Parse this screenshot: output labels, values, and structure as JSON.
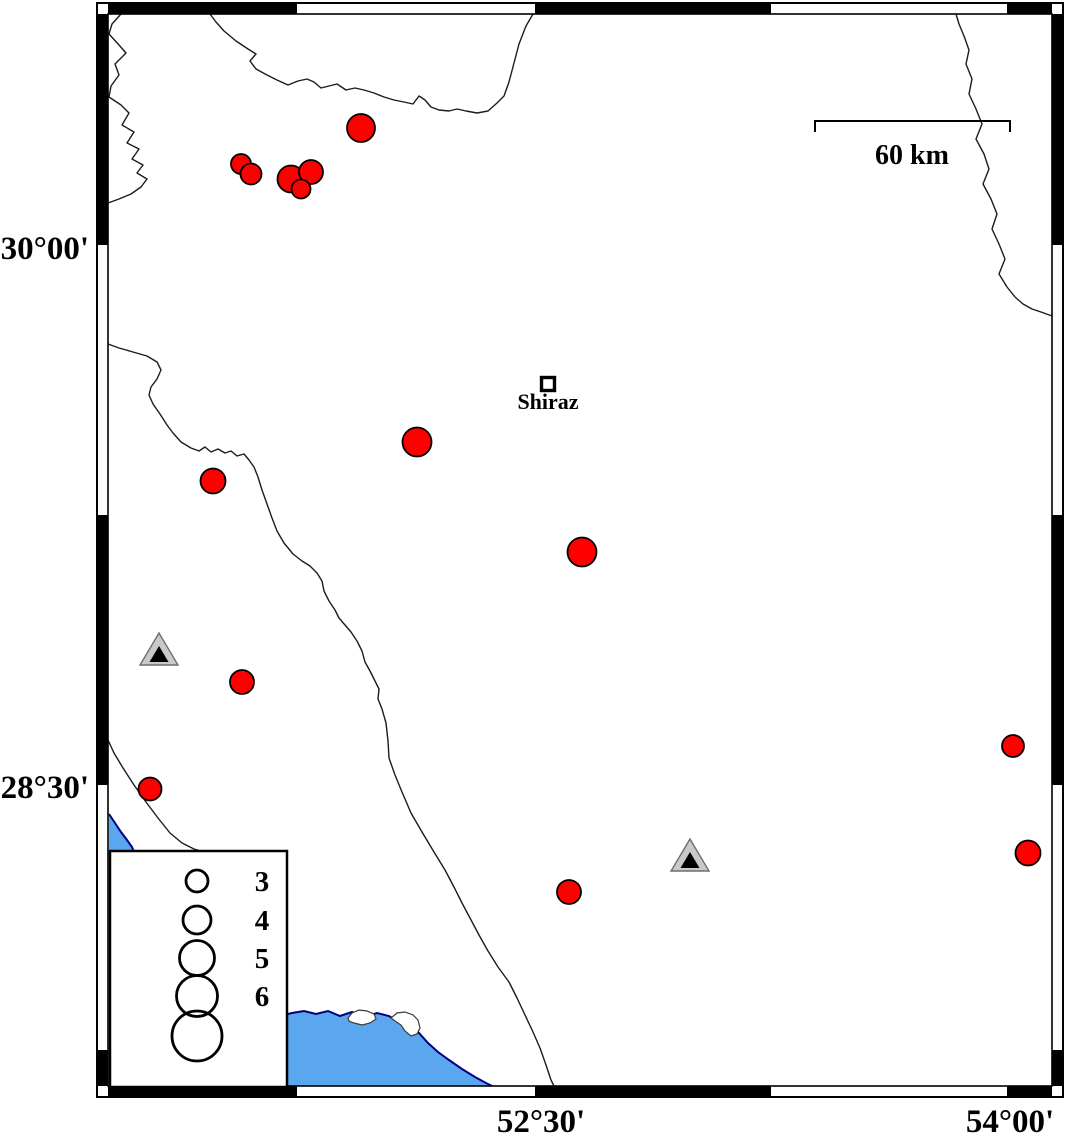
{
  "map": {
    "width": 1066,
    "height": 1136,
    "colors": {
      "background": "#ffffff",
      "frame": "#000000",
      "quake_fill": "#ff0000",
      "quake_stroke": "#000000",
      "station_fill": "#c9c9c9",
      "station_stroke": "#6e6e6e",
      "station_inner": "#000000",
      "water_fill": "#5aa7f0",
      "coast_stroke": "#000080",
      "river_stroke": "#1c1c1c",
      "island_fill": "#ffffff",
      "island_stroke": "#3a3a3a"
    },
    "frame": {
      "outer": {
        "x": 97,
        "y": 3,
        "w": 966,
        "h": 1094
      },
      "inner": {
        "x": 108,
        "y": 14,
        "w": 944,
        "h": 1072
      },
      "h_black_segments": [
        [
          108,
          297
        ],
        [
          535,
          771
        ],
        [
          1007,
          1052
        ]
      ],
      "v_black_segments": [
        [
          14,
          245
        ],
        [
          515,
          785
        ],
        [
          1050,
          1086
        ]
      ]
    },
    "axis_labels": {
      "left": [
        {
          "text": "30°00'",
          "y": 259
        },
        {
          "text": "28°30'",
          "y": 798
        }
      ],
      "bottom": [
        {
          "text": "52°30'",
          "x": 541
        },
        {
          "text": "54°00'",
          "x": 1010
        }
      ]
    },
    "scale_bar": {
      "x1": 815,
      "x2": 1010,
      "y": 121,
      "tick_drop": 11,
      "label": "60 km"
    },
    "city": {
      "name": "Shiraz",
      "x": 548,
      "y": 384,
      "marker_size": 13
    },
    "earthquakes": [
      {
        "x": 361,
        "y": 128,
        "r": 14
      },
      {
        "x": 241,
        "y": 164,
        "r": 10
      },
      {
        "x": 251,
        "y": 174,
        "r": 10.5
      },
      {
        "x": 291,
        "y": 179,
        "r": 13.5
      },
      {
        "x": 311,
        "y": 172,
        "r": 12
      },
      {
        "x": 301,
        "y": 189,
        "r": 9.5
      },
      {
        "x": 417,
        "y": 442,
        "r": 14.5
      },
      {
        "x": 213,
        "y": 481,
        "r": 12.5
      },
      {
        "x": 582,
        "y": 552,
        "r": 14.5
      },
      {
        "x": 242,
        "y": 682,
        "r": 12
      },
      {
        "x": 150,
        "y": 789,
        "r": 11.5
      },
      {
        "x": 569,
        "y": 892,
        "r": 12
      },
      {
        "x": 1013,
        "y": 746,
        "r": 11
      },
      {
        "x": 1028,
        "y": 853,
        "r": 12.5
      }
    ],
    "stations": [
      {
        "x": 159,
        "y": 649
      },
      {
        "x": 690,
        "y": 855
      }
    ],
    "station_shape": {
      "half_w": 19,
      "half_h": 16,
      "inner_half_w": 9.5,
      "inner_apex_dy": 13,
      "inner_base_dy": 13
    },
    "legend": {
      "box": {
        "x": 110,
        "y": 851,
        "w": 177,
        "h": 236
      },
      "circle_cx": 197,
      "label_x": 262,
      "entries": [
        {
          "label": "3",
          "cy": 881,
          "r": 11
        },
        {
          "label": "4",
          "cy": 920,
          "r": 14
        },
        {
          "label": "5",
          "cy": 958,
          "r": 17.5
        },
        {
          "label": "6",
          "cy": 996,
          "r": 20.5
        },
        {
          "label": "",
          "cy": 1036,
          "r": 25
        }
      ]
    },
    "rivers": [
      {
        "name": "northwest-border",
        "points": [
          [
            121,
            14
          ],
          [
            112,
            24
          ],
          [
            109,
            34
          ],
          [
            119,
            45
          ],
          [
            126,
            53
          ],
          [
            115,
            64
          ],
          [
            119,
            75
          ],
          [
            111,
            86
          ],
          [
            109,
            97
          ],
          [
            121,
            105
          ],
          [
            129,
            113
          ],
          [
            122,
            125
          ],
          [
            134,
            132
          ],
          [
            127,
            143
          ],
          [
            139,
            149
          ],
          [
            132,
            159
          ],
          [
            143,
            165
          ],
          [
            137,
            173
          ],
          [
            147,
            179
          ],
          [
            141,
            187
          ],
          [
            131,
            194
          ],
          [
            119,
            199
          ],
          [
            108,
            203
          ]
        ]
      },
      {
        "name": "west-diagonal-border",
        "points": [
          [
            108,
            344
          ],
          [
            119,
            348
          ],
          [
            133,
            352
          ],
          [
            147,
            356
          ],
          [
            157,
            362
          ],
          [
            161,
            370
          ],
          [
            157,
            379
          ],
          [
            151,
            387
          ],
          [
            149,
            395
          ],
          [
            153,
            404
          ],
          [
            160,
            414
          ],
          [
            167,
            425
          ],
          [
            173,
            433
          ],
          [
            181,
            442
          ],
          [
            191,
            448
          ],
          [
            199,
            451
          ],
          [
            205,
            447
          ],
          [
            211,
            452
          ],
          [
            218,
            449
          ],
          [
            225,
            453
          ],
          [
            231,
            451
          ],
          [
            237,
            456
          ],
          [
            244,
            454
          ],
          [
            249,
            460
          ],
          [
            254,
            467
          ],
          [
            258,
            477
          ],
          [
            262,
            490
          ],
          [
            267,
            504
          ],
          [
            272,
            518
          ],
          [
            277,
            531
          ],
          [
            284,
            543
          ],
          [
            293,
            554
          ],
          [
            302,
            561
          ],
          [
            310,
            566
          ],
          [
            317,
            573
          ],
          [
            322,
            581
          ],
          [
            324,
            591
          ],
          [
            329,
            601
          ],
          [
            335,
            610
          ],
          [
            339,
            618
          ],
          [
            345,
            625
          ],
          [
            351,
            632
          ],
          [
            357,
            641
          ],
          [
            362,
            651
          ],
          [
            365,
            662
          ],
          [
            370,
            671
          ],
          [
            374,
            679
          ],
          [
            379,
            689
          ],
          [
            378,
            699
          ],
          [
            382,
            709
          ],
          [
            386,
            723
          ],
          [
            388,
            741
          ],
          [
            389,
            758
          ],
          [
            395,
            775
          ],
          [
            402,
            792
          ],
          [
            411,
            813
          ],
          [
            422,
            832
          ],
          [
            434,
            852
          ],
          [
            445,
            870
          ],
          [
            454,
            887
          ],
          [
            462,
            903
          ],
          [
            470,
            918
          ],
          [
            479,
            935
          ],
          [
            488,
            951
          ],
          [
            498,
            967
          ],
          [
            509,
            982
          ],
          [
            517,
            998
          ],
          [
            525,
            1015
          ],
          [
            533,
            1032
          ],
          [
            540,
            1048
          ],
          [
            546,
            1065
          ],
          [
            551,
            1080
          ],
          [
            554,
            1086
          ]
        ]
      },
      {
        "name": "north-valley-border",
        "points": [
          [
            210,
            14
          ],
          [
            216,
            22
          ],
          [
            224,
            31
          ],
          [
            236,
            41
          ],
          [
            248,
            49
          ],
          [
            256,
            54
          ],
          [
            250,
            61
          ],
          [
            256,
            69
          ],
          [
            267,
            75
          ],
          [
            277,
            80
          ],
          [
            288,
            85
          ],
          [
            298,
            81
          ],
          [
            307,
            79
          ],
          [
            314,
            82
          ],
          [
            321,
            88
          ],
          [
            329,
            86
          ],
          [
            337,
            84
          ],
          [
            346,
            90
          ],
          [
            355,
            88
          ],
          [
            364,
            90
          ],
          [
            374,
            93
          ],
          [
            384,
            97
          ],
          [
            394,
            100
          ],
          [
            404,
            102
          ],
          [
            413,
            104
          ],
          [
            419,
            96
          ],
          [
            425,
            100
          ],
          [
            431,
            107
          ],
          [
            439,
            110
          ],
          [
            449,
            111
          ],
          [
            457,
            109
          ],
          [
            466,
            111
          ],
          [
            477,
            113
          ],
          [
            488,
            111
          ],
          [
            497,
            103
          ],
          [
            504,
            96
          ],
          [
            509,
            82
          ],
          [
            514,
            63
          ],
          [
            519,
            44
          ],
          [
            526,
            26
          ],
          [
            533,
            14
          ]
        ]
      },
      {
        "name": "east-river",
        "points": [
          [
            956,
            14
          ],
          [
            959,
            24
          ],
          [
            964,
            36
          ],
          [
            969,
            50
          ],
          [
            966,
            64
          ],
          [
            972,
            79
          ],
          [
            969,
            94
          ],
          [
            976,
            109
          ],
          [
            982,
            124
          ],
          [
            976,
            139
          ],
          [
            984,
            154
          ],
          [
            989,
            169
          ],
          [
            983,
            184
          ],
          [
            991,
            199
          ],
          [
            997,
            214
          ],
          [
            992,
            229
          ],
          [
            999,
            244
          ],
          [
            1005,
            259
          ],
          [
            999,
            274
          ],
          [
            1007,
            287
          ],
          [
            1015,
            297
          ],
          [
            1023,
            304
          ],
          [
            1032,
            309
          ],
          [
            1041,
            312
          ],
          [
            1052,
            316
          ]
        ]
      },
      {
        "name": "southwest-line",
        "points": [
          [
            108,
            740
          ],
          [
            114,
            753
          ],
          [
            123,
            768
          ],
          [
            134,
            785
          ],
          [
            146,
            802
          ],
          [
            158,
            818
          ],
          [
            170,
            833
          ],
          [
            182,
            843
          ],
          [
            194,
            849
          ],
          [
            208,
            853
          ]
        ]
      }
    ],
    "water_bodies": [
      {
        "name": "gulf",
        "points": [
          [
            280,
            1016
          ],
          [
            292,
            1013
          ],
          [
            304,
            1011
          ],
          [
            316,
            1014
          ],
          [
            328,
            1011
          ],
          [
            340,
            1016
          ],
          [
            352,
            1012
          ],
          [
            364,
            1017
          ],
          [
            377,
            1013
          ],
          [
            389,
            1016
          ],
          [
            397,
            1021
          ],
          [
            405,
            1018
          ],
          [
            412,
            1026
          ],
          [
            419,
            1033
          ],
          [
            428,
            1043
          ],
          [
            438,
            1052
          ],
          [
            449,
            1060
          ],
          [
            462,
            1069
          ],
          [
            475,
            1077
          ],
          [
            486,
            1083
          ],
          [
            494,
            1087
          ],
          [
            280,
            1087
          ]
        ],
        "coast_end_index": 20
      },
      {
        "name": "west-inlet",
        "points": [
          [
            109,
            814
          ],
          [
            115,
            823
          ],
          [
            121,
            832
          ],
          [
            127,
            840
          ],
          [
            132,
            847
          ],
          [
            134,
            852
          ],
          [
            109,
            852
          ]
        ],
        "coast_end_index": 5
      }
    ],
    "islands": [
      {
        "name": "lagoon-island-1",
        "points": [
          [
            348,
            1018
          ],
          [
            352,
            1013
          ],
          [
            359,
            1010
          ],
          [
            367,
            1011
          ],
          [
            374,
            1014
          ],
          [
            376,
            1019
          ],
          [
            370,
            1023
          ],
          [
            362,
            1025
          ],
          [
            354,
            1023
          ],
          [
            349,
            1021
          ]
        ]
      },
      {
        "name": "lagoon-island-2",
        "points": [
          [
            391,
            1018
          ],
          [
            397,
            1013
          ],
          [
            405,
            1012
          ],
          [
            413,
            1015
          ],
          [
            418,
            1020
          ],
          [
            420,
            1028
          ],
          [
            417,
            1034
          ],
          [
            411,
            1036
          ],
          [
            405,
            1031
          ],
          [
            401,
            1025
          ],
          [
            395,
            1021
          ]
        ]
      }
    ]
  }
}
